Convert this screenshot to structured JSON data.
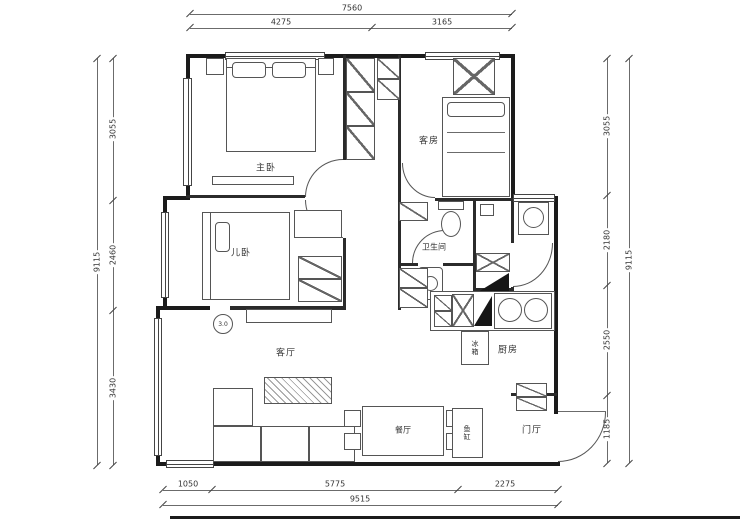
{
  "rooms": {
    "master": "主卧",
    "guest": "客房",
    "kids": "儿卧",
    "bath": "卫生间",
    "living": "客厅",
    "kitchen": "厨房",
    "dining": "餐厅",
    "entry": "门厅"
  },
  "items": {
    "fridge": "冰箱",
    "fish_tank": "鱼缸",
    "marker": "3.0"
  },
  "dimensions": {
    "top": {
      "total": "7560",
      "seg1": "4275",
      "seg2": "3165"
    },
    "bottom": {
      "total": "9515",
      "seg1": "1050",
      "seg2": "5775",
      "seg3": "2275"
    },
    "left": {
      "total": "9115",
      "seg1": "3055",
      "seg2": "2460",
      "seg3": "3430"
    },
    "right": {
      "total": "9115",
      "seg1": "3055",
      "seg2": "2180",
      "seg3": "2550",
      "seg4": "1185"
    }
  }
}
